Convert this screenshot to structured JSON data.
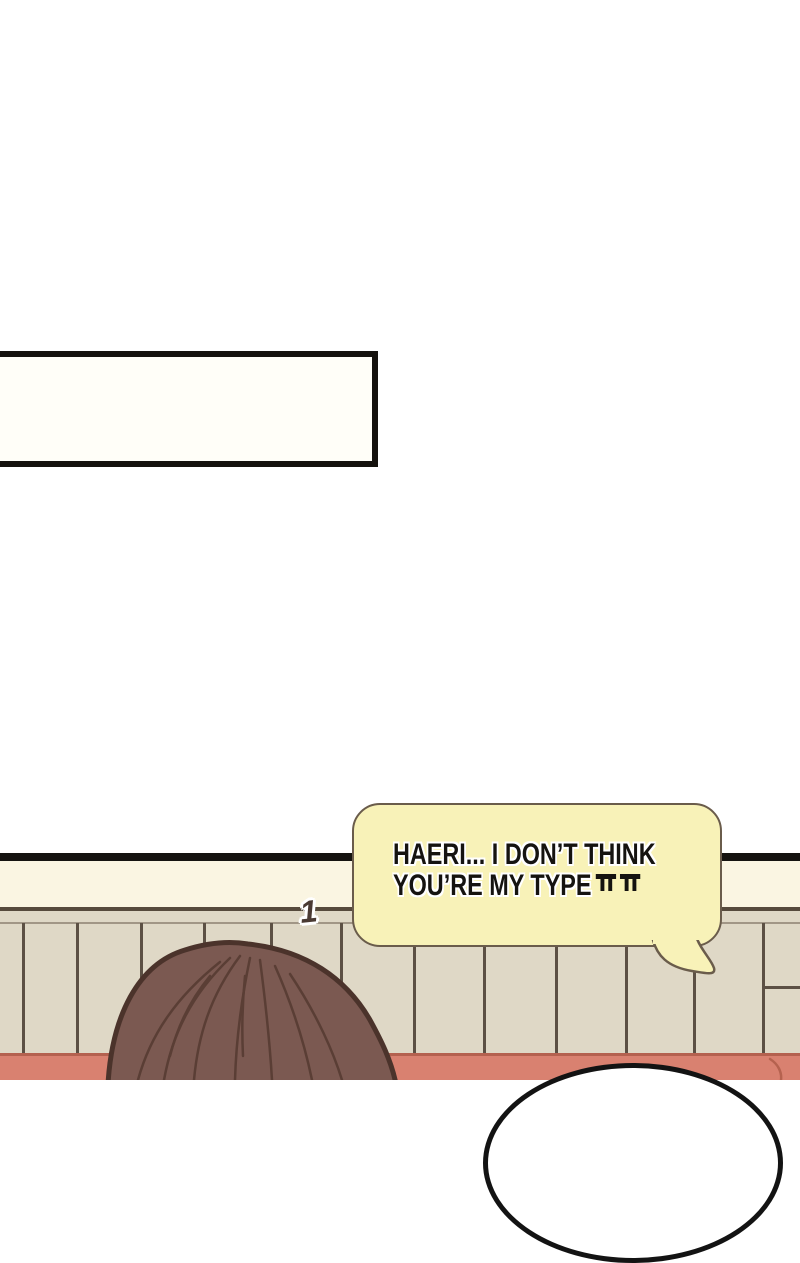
{
  "page": {
    "background": "#ffffff"
  },
  "caption_box": {
    "text": ""
  },
  "speech_bubble": {
    "line1": "HAERI... I DON’T THINK",
    "line2": "YOU’RE MY TYPE",
    "emoticon": "ㅠㅠ",
    "fill": "#F8F2B8",
    "outline": "#6A5C4B"
  },
  "effect_label": {
    "text": "1"
  },
  "scene": {
    "colors": {
      "panel_line_black": "#151310",
      "cream_band": "#FAF5E2",
      "wall_beige": "#DFD8C6",
      "wall_trim": "#564A3C",
      "wall_plank_line": "#5C5044",
      "floor_pink": "#D98170",
      "floor_edge_dark": "#B4614F",
      "hair_brown": "#7B5951",
      "hair_outline": "#4B332B",
      "white_head": "#FFFFFF"
    }
  }
}
